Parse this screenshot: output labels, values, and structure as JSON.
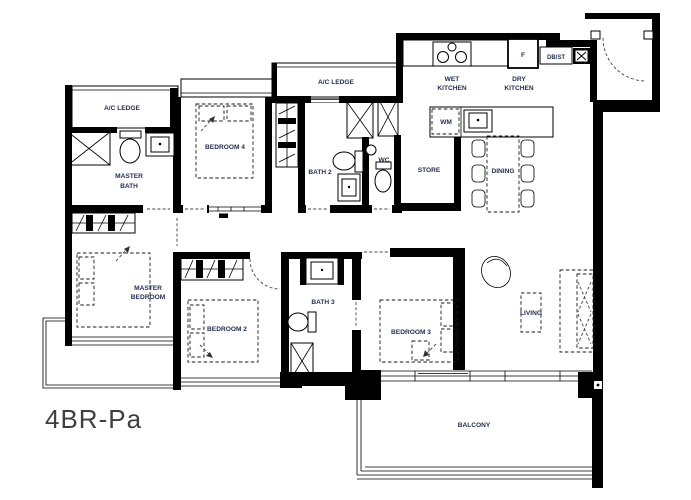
{
  "plan": {
    "unit_type": "4BR-Pa",
    "labels": {
      "ac_ledge_left": "A/C LEDGE",
      "ac_ledge_mid": "A/C LEDGE",
      "master_bath_1": "MASTER",
      "master_bath_2": "BATH",
      "bedroom_4": "BEDROOM 4",
      "bath_2": "BATH 2",
      "wc": "WC",
      "wet_kitchen_1": "WET",
      "wet_kitchen_2": "KITCHEN",
      "dry_kitchen_1": "DRY",
      "dry_kitchen_2": "KITCHEN",
      "fridge": "F",
      "db_st": "DB/ST",
      "wm": "WM",
      "store": "STORE",
      "dining": "DINING",
      "master_bedroom_1": "MASTER",
      "master_bedroom_2": "BEDROOM",
      "bedroom_2": "BEDROOM 2",
      "bath_3": "BATH 3",
      "bedroom_3": "BEDROOM 3",
      "living": "LIVING",
      "balcony": "BALCONY"
    },
    "colors": {
      "wall": "#000000",
      "room_label": "#233055",
      "unit_label": "#3f3f3f",
      "background": "#ffffff"
    }
  }
}
